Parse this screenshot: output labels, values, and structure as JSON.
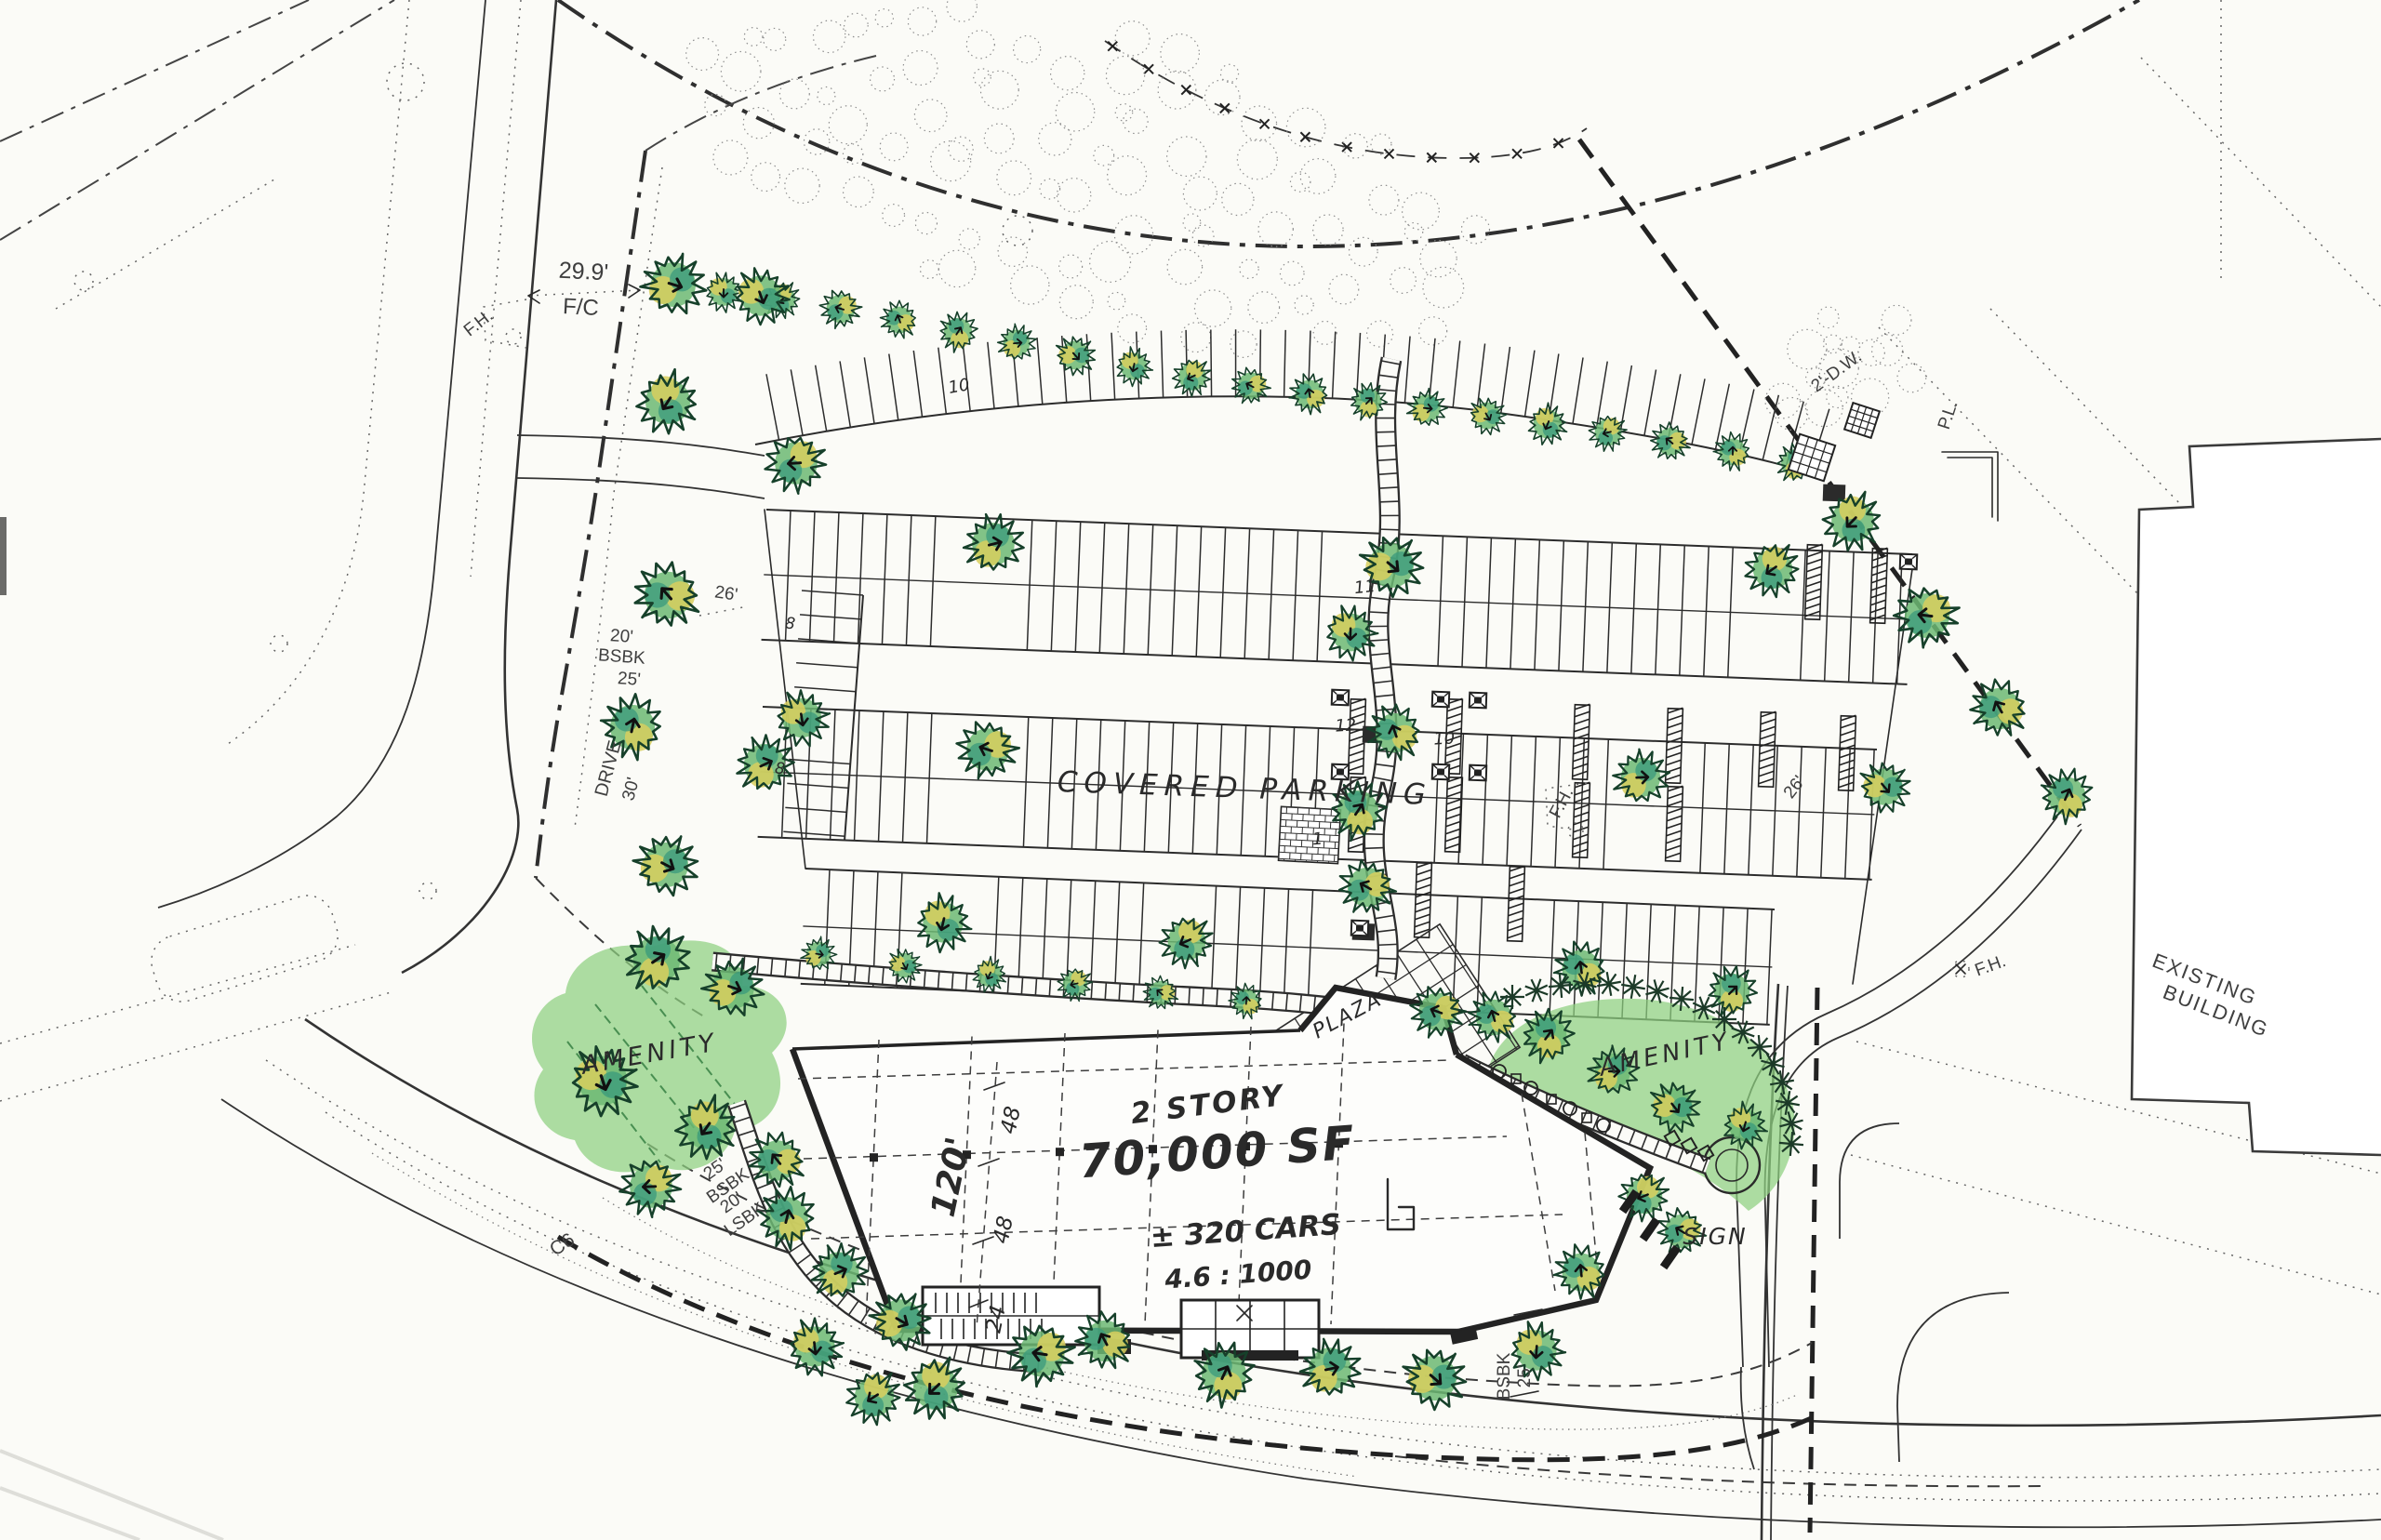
{
  "drawing": {
    "kind": "landscape site plan",
    "parking_note": "COVERED PARKING",
    "building": {
      "story": "2 STORY",
      "area": "70,000 SF",
      "cars": "± 320 CARS",
      "ratio": "4.6 : 1000",
      "dim_120": "120'",
      "dim_48a": "48",
      "dim_48b": "48",
      "dim_24": "24"
    },
    "areas": {
      "amenity_west": "AMENITY",
      "amenity_east": "AMENITY",
      "plaza": "PLAZA",
      "sign": "SIGN",
      "existing_building_line1": "EXISTING",
      "existing_building_line2": "BUILDING"
    },
    "dims": {
      "face_of_curb_value": "29.9'",
      "face_of_curb_sub": "F/C",
      "aisle_west": "26'",
      "aisle_east": "26'",
      "setback_w_value": "20'",
      "setback_w_label": "BSBK",
      "setback_w_value2": "25'",
      "drive_label": "DRIVE",
      "drive_width": "30'",
      "setback_sw_value": "25'",
      "setback_sw_label": "BSBK",
      "setback_sw_value2": "20'",
      "setback_sw_label2": "LSBK",
      "setback_se_value": "25'",
      "setback_se_label": "BSBK",
      "drainage": "2'-D.W.",
      "property_line": "P.L.",
      "curb_note": "C6"
    },
    "symbols": {
      "fire_hydrant": "F.H."
    },
    "stall_counts": {
      "top_row": "10",
      "row2": "11",
      "row3_left": "12",
      "row3_right": "10",
      "row4": "1",
      "west_a": "8",
      "west_b": "8"
    },
    "colors": {
      "paper": "#fbfbf7",
      "ink": "#2a2a2a",
      "tree_green": "#6cb873",
      "tree_teal": "#3a9a7c",
      "tree_yellow": "#d8cf5e",
      "lawn_green": "#8ed07f"
    }
  }
}
